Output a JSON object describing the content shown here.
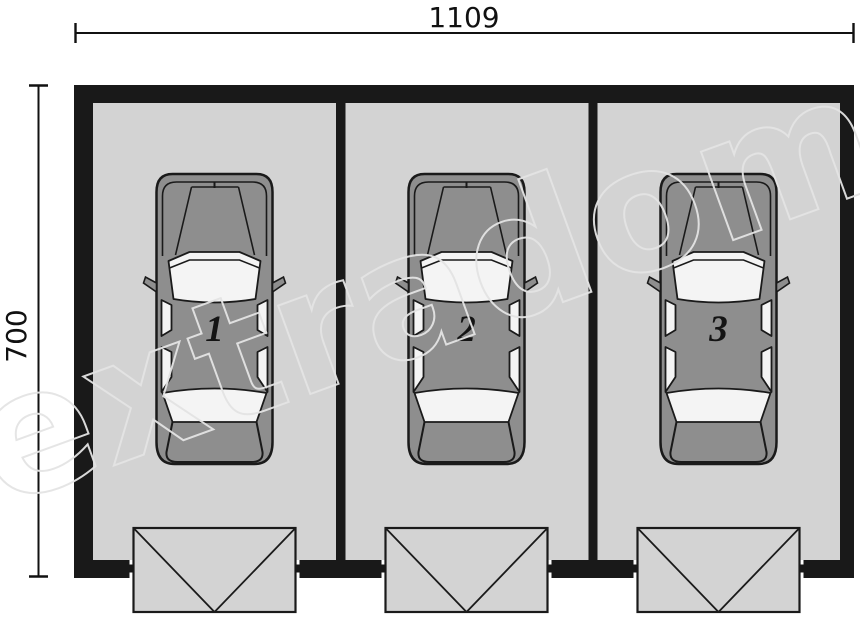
{
  "plan": {
    "title": "three-bay-garage-floor-plan",
    "dimensions": {
      "width_label": "1109",
      "height_label": "700"
    },
    "bays": [
      {
        "number": "1"
      },
      {
        "number": "2"
      },
      {
        "number": "3"
      }
    ],
    "watermark": "extradom"
  },
  "colors": {
    "wall": "#191919",
    "floor": "#d3d3d3",
    "car_body": "#8e8e8e",
    "glass": "#f4f4f4",
    "outline": "#1a1a1a",
    "dimension": "#111111",
    "watermark": "#e4e4e4"
  }
}
